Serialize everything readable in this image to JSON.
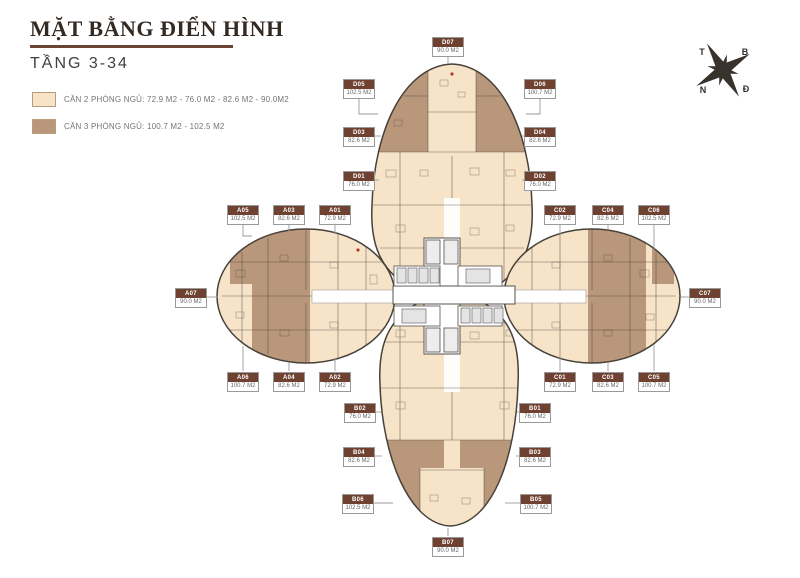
{
  "header": {
    "title": "MẶT BẰNG ĐIỂN HÌNH",
    "subtitle": "TẦNG 3-34"
  },
  "legend": {
    "items": [
      {
        "label": "CĂN 2 PHÒNG NGỦ: 72.9 M2 - 76.0 M2 - 82.6 M2 - 90.0M2",
        "color": "#f6e3c8"
      },
      {
        "label": "CĂN 3 PHÒNG NGỦ: 100.7 M2 - 102.5 M2",
        "color": "#b9977a"
      }
    ]
  },
  "compass": {
    "t": "T",
    "b": "B",
    "n": "N",
    "d": "Đ"
  },
  "colors": {
    "cream": "#f6e3c8",
    "tan": "#b9977a",
    "wall": "#46413b",
    "label_bg": "#6f4130",
    "underline": "#6b4433",
    "connector": "#9a9a9a"
  },
  "units": [
    {
      "code": "D07",
      "area": "90.0 M2",
      "x": 448,
      "y": 37,
      "line": [
        [
          448,
          55
        ],
        [
          448,
          64
        ]
      ]
    },
    {
      "code": "D05",
      "area": "102.5 M2",
      "x": 359,
      "y": 79,
      "line": [
        [
          359,
          97
        ],
        [
          359,
          114
        ],
        [
          378,
          114
        ]
      ]
    },
    {
      "code": "D06",
      "area": "100.7 M2",
      "x": 540,
      "y": 79,
      "line": [
        [
          540,
          97
        ],
        [
          540,
          114
        ],
        [
          526,
          114
        ]
      ]
    },
    {
      "code": "D03",
      "area": "82.6 M2",
      "x": 359,
      "y": 127,
      "line": [
        [
          374,
          136
        ],
        [
          381,
          136
        ]
      ]
    },
    {
      "code": "D04",
      "area": "82.6 M2",
      "x": 540,
      "y": 127,
      "line": [
        [
          525,
          136
        ],
        [
          522,
          136
        ]
      ]
    },
    {
      "code": "D01",
      "area": "76.0 M2",
      "x": 359,
      "y": 171,
      "line": [
        [
          374,
          180
        ],
        [
          379,
          180
        ]
      ]
    },
    {
      "code": "D02",
      "area": "76.0 M2",
      "x": 540,
      "y": 171,
      "line": [
        [
          525,
          180
        ],
        [
          522,
          180
        ]
      ]
    },
    {
      "code": "A05",
      "area": "102.5 M2",
      "x": 243,
      "y": 205,
      "line": [
        [
          243,
          223
        ],
        [
          243,
          236
        ],
        [
          252,
          236
        ]
      ]
    },
    {
      "code": "A03",
      "area": "82.6 M2",
      "x": 289,
      "y": 205,
      "line": [
        [
          289,
          223
        ],
        [
          289,
          231
        ]
      ]
    },
    {
      "code": "A01",
      "area": "72.9 M2",
      "x": 335,
      "y": 205,
      "line": [
        [
          335,
          223
        ],
        [
          335,
          234
        ]
      ]
    },
    {
      "code": "C02",
      "area": "72.9 M2",
      "x": 560,
      "y": 205,
      "line": [
        [
          560,
          223
        ],
        [
          560,
          234
        ]
      ]
    },
    {
      "code": "C04",
      "area": "82.6 M2",
      "x": 608,
      "y": 205,
      "line": [
        [
          608,
          223
        ],
        [
          608,
          230
        ]
      ]
    },
    {
      "code": "C06",
      "area": "102.5 M2",
      "x": 654,
      "y": 205,
      "line": [
        [
          654,
          223
        ],
        [
          654,
          249
        ]
      ]
    },
    {
      "code": "A07",
      "area": "90.0 M2",
      "x": 191,
      "y": 288,
      "line": [
        [
          206,
          297
        ],
        [
          218,
          297
        ]
      ]
    },
    {
      "code": "C07",
      "area": "90.0 M2",
      "x": 705,
      "y": 288,
      "line": [
        [
          690,
          297
        ],
        [
          681,
          297
        ]
      ]
    },
    {
      "code": "A06",
      "area": "100.7 M2",
      "x": 243,
      "y": 372,
      "line": [
        [
          243,
          371
        ],
        [
          243,
          346
        ]
      ]
    },
    {
      "code": "A04",
      "area": "82.6 M2",
      "x": 289,
      "y": 372,
      "line": [
        [
          289,
          371
        ],
        [
          289,
          362
        ]
      ]
    },
    {
      "code": "A02",
      "area": "72.9 M2",
      "x": 335,
      "y": 372,
      "line": [
        [
          335,
          371
        ],
        [
          335,
          359
        ]
      ]
    },
    {
      "code": "C01",
      "area": "72.9 M2",
      "x": 560,
      "y": 372,
      "line": [
        [
          560,
          371
        ],
        [
          560,
          358
        ]
      ]
    },
    {
      "code": "C03",
      "area": "82.6 M2",
      "x": 608,
      "y": 372,
      "line": [
        [
          608,
          371
        ],
        [
          608,
          362
        ]
      ]
    },
    {
      "code": "C05",
      "area": "100.7 M2",
      "x": 654,
      "y": 372,
      "line": [
        [
          654,
          371
        ],
        [
          654,
          344
        ]
      ]
    },
    {
      "code": "B02",
      "area": "76.0 M2",
      "x": 360,
      "y": 403,
      "line": [
        [
          375,
          412
        ],
        [
          381,
          412
        ]
      ]
    },
    {
      "code": "B01",
      "area": "76.0 M2",
      "x": 535,
      "y": 403,
      "line": [
        [
          520,
          412
        ],
        [
          517,
          412
        ]
      ]
    },
    {
      "code": "B04",
      "area": "82.6 M2",
      "x": 359,
      "y": 447,
      "line": [
        [
          374,
          456
        ],
        [
          382,
          456
        ]
      ]
    },
    {
      "code": "B03",
      "area": "82.6 M2",
      "x": 535,
      "y": 447,
      "line": [
        [
          520,
          456
        ],
        [
          516,
          456
        ]
      ]
    },
    {
      "code": "B06",
      "area": "102.5 M2",
      "x": 358,
      "y": 494,
      "line": [
        [
          373,
          503
        ],
        [
          393,
          503
        ]
      ]
    },
    {
      "code": "B05",
      "area": "100.7 M2",
      "x": 536,
      "y": 494,
      "line": [
        [
          521,
          503
        ],
        [
          505,
          503
        ]
      ]
    },
    {
      "code": "B07",
      "area": "90.0 M2",
      "x": 448,
      "y": 537,
      "line": [
        [
          448,
          536
        ],
        [
          448,
          528
        ]
      ]
    }
  ]
}
